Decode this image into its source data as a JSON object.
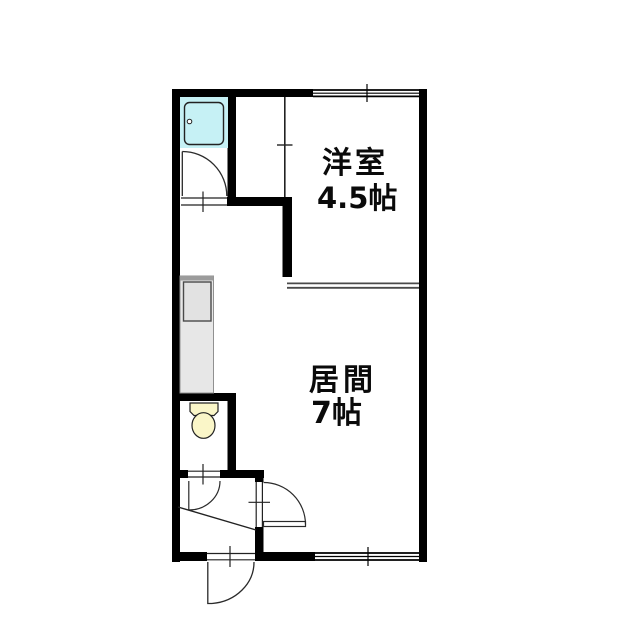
{
  "plan": {
    "rooms": [
      {
        "id": "western-room",
        "name": "洋室",
        "area": "4.5帖"
      },
      {
        "id": "living-room",
        "name": "居間",
        "area": "7帖"
      }
    ],
    "fixtures": [
      "unit-bath",
      "kitchen-counter",
      "toilet",
      "bathroom-door",
      "toilet-door",
      "living-room-door",
      "entrance-door",
      "window-top",
      "window-bottom",
      "entrance-step-line"
    ],
    "colors": {
      "wall": "#000000",
      "bath_fill": "#c6f1f5",
      "toilet_fill": "#faf6c8",
      "counter_fill": "#e7e7e7",
      "counter_top": "#9b9b9b",
      "sink_fill": "#e2e2e2"
    }
  }
}
